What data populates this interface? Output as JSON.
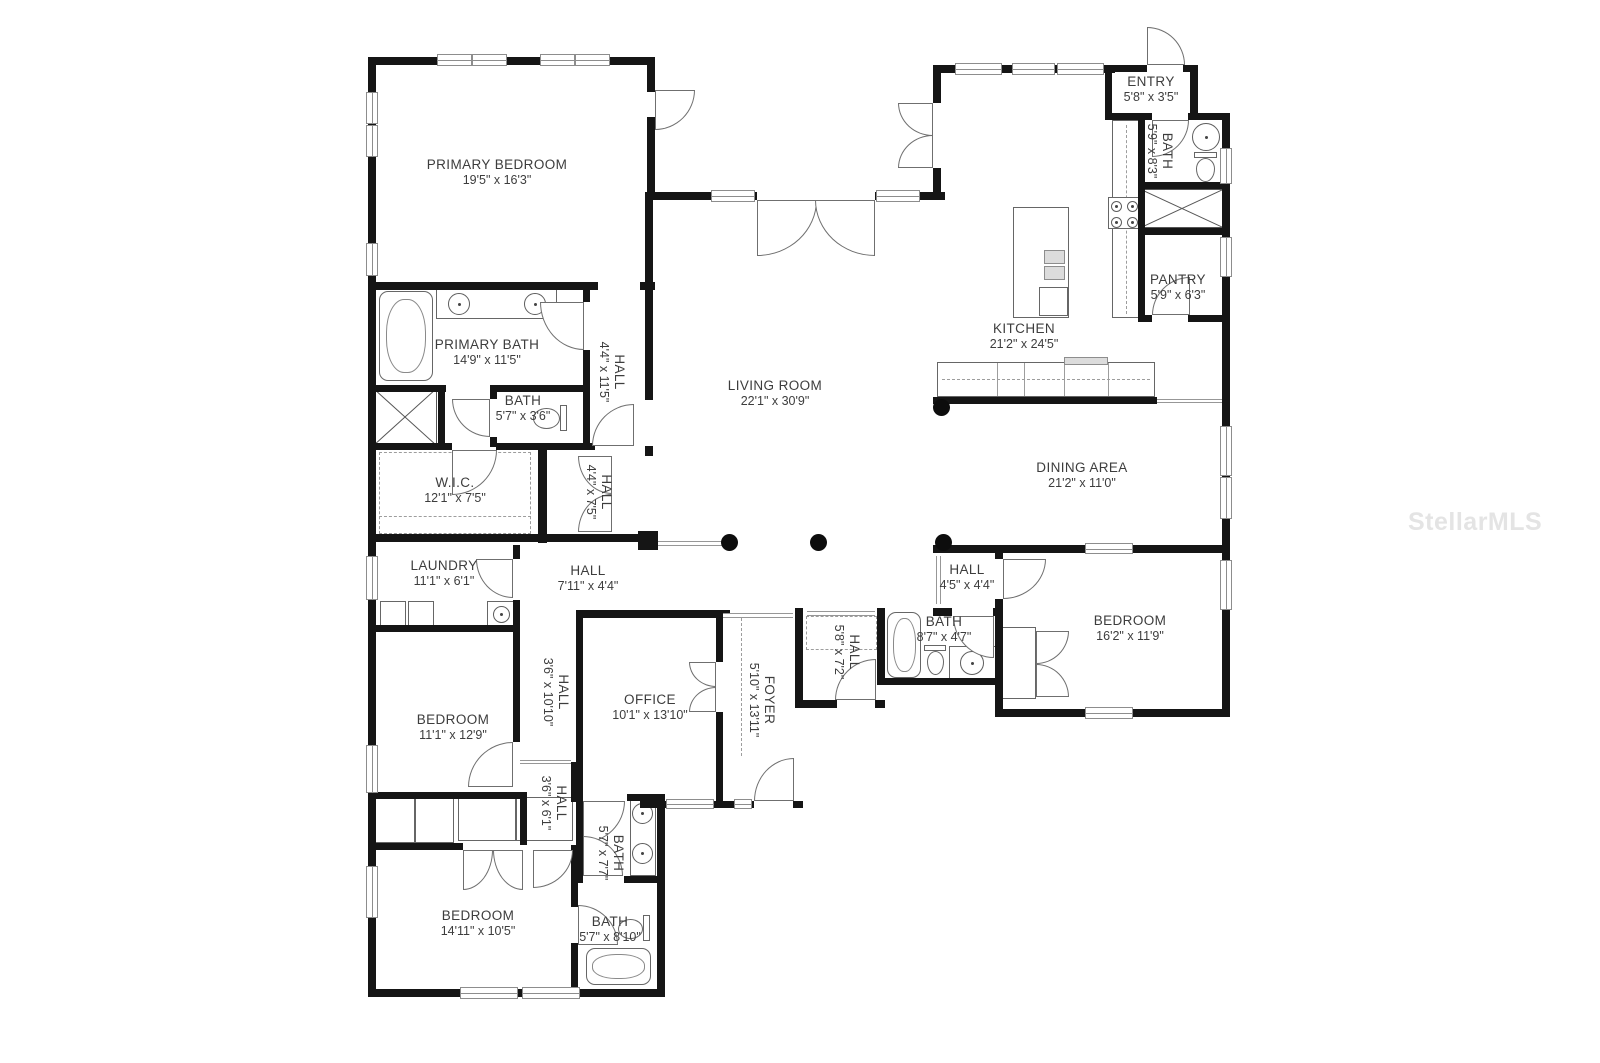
{
  "watermark": "StellarMLS",
  "colors": {
    "wall": "#151515",
    "label": "#3d3d3d",
    "watermark": "#e4e4e4"
  },
  "rooms": [
    {
      "id": "primary-bedroom",
      "name": "PRIMARY BEDROOM",
      "dims": "19'5\" x 16'3\""
    },
    {
      "id": "primary-bath",
      "name": "PRIMARY BATH",
      "dims": "14'9\" x 11'5\""
    },
    {
      "id": "bath-hall",
      "name": "BATH",
      "dims": "5'7\" x 3'6\""
    },
    {
      "id": "hall-a",
      "name": "HALL",
      "dims": "4'4\" x 11'5\""
    },
    {
      "id": "wic",
      "name": "W.I.C.",
      "dims": "12'1\" x 7'5\""
    },
    {
      "id": "hall-b",
      "name": "HALL",
      "dims": "4'4\" x 7'5\""
    },
    {
      "id": "laundry",
      "name": "LAUNDRY",
      "dims": "11'1\" x 6'1\""
    },
    {
      "id": "hall-c",
      "name": "HALL",
      "dims": "7'11\" x 4'4\""
    },
    {
      "id": "bedroom-1",
      "name": "BEDROOM",
      "dims": "11'1\" x 12'9\""
    },
    {
      "id": "hall-d",
      "name": "HALL",
      "dims": "3'6\" x 10'10\""
    },
    {
      "id": "office",
      "name": "OFFICE",
      "dims": "10'1\" x 13'10\""
    },
    {
      "id": "foyer",
      "name": "FOYER",
      "dims": "5'10\" x 13'11\""
    },
    {
      "id": "hall-e",
      "name": "HALL",
      "dims": "5'8\" x 7'2\""
    },
    {
      "id": "hall-f",
      "name": "HALL",
      "dims": "3'6\" x 6'1\""
    },
    {
      "id": "bath-2",
      "name": "BATH",
      "dims": "5'7\" x 7'7\""
    },
    {
      "id": "bedroom-2",
      "name": "BEDROOM",
      "dims": "14'11\" x 10'5\""
    },
    {
      "id": "bath-3",
      "name": "BATH",
      "dims": "5'7\" x 8'10\""
    },
    {
      "id": "living-room",
      "name": "LIVING ROOM",
      "dims": "22'1\" x 30'9\""
    },
    {
      "id": "kitchen",
      "name": "KITCHEN",
      "dims": "21'2\" x 24'5\""
    },
    {
      "id": "entry",
      "name": "ENTRY",
      "dims": "5'8\" x 3'5\""
    },
    {
      "id": "bath-4",
      "name": "BATH",
      "dims": "5'9\" x 8'3\""
    },
    {
      "id": "pantry",
      "name": "PANTRY",
      "dims": "5'9\" x 6'3\""
    },
    {
      "id": "dining-area",
      "name": "DINING AREA",
      "dims": "21'2\" x 11'0\""
    },
    {
      "id": "bedroom-3",
      "name": "BEDROOM",
      "dims": "16'2\" x 11'9\""
    },
    {
      "id": "hall-g",
      "name": "HALL",
      "dims": "4'5\" x 4'4\""
    },
    {
      "id": "bath-5",
      "name": "BATH",
      "dims": "8'7\" x 4'7\""
    }
  ]
}
